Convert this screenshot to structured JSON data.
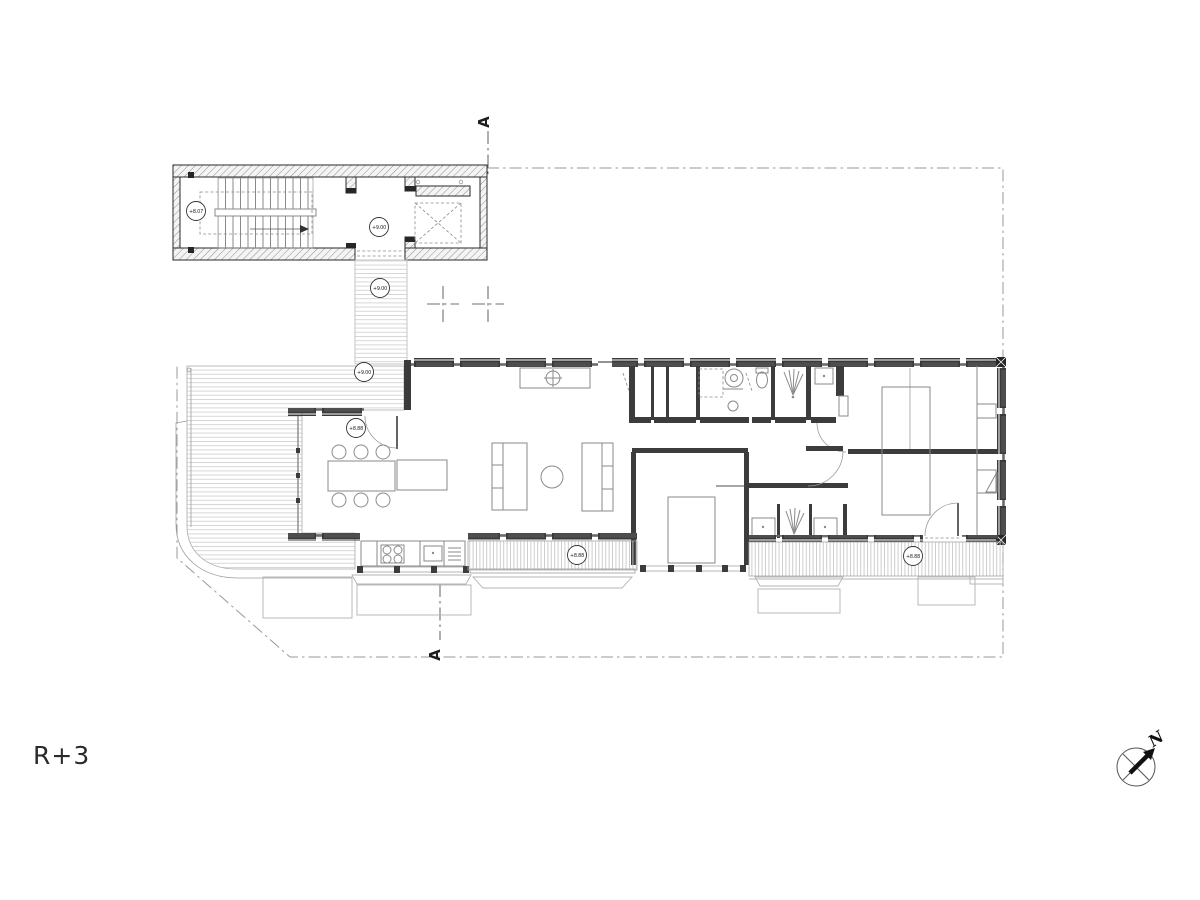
{
  "title": {
    "floor_label": "R+3"
  },
  "compass": {
    "north_label": "N"
  },
  "section": {
    "top_label": "A",
    "bottom_label": "A"
  },
  "levels": [
    {
      "id": "stair-flight",
      "value": "+8.07"
    },
    {
      "id": "stair-landing",
      "value": "+9.00"
    },
    {
      "id": "walkway",
      "value": "+9.00"
    },
    {
      "id": "terrace-deck",
      "value": "+9.00"
    },
    {
      "id": "living-room",
      "value": "+8.88"
    },
    {
      "id": "south-balcony",
      "value": "+8.88"
    },
    {
      "id": "east-balcony",
      "value": "+8.88"
    }
  ],
  "colors": {
    "paper": "#ffffff",
    "wall_hatch_line": "#8f8f8f",
    "wall_outline": "#2a2a2a",
    "glazing_dark": "#3a3a3a",
    "partition": "#3c3c3c",
    "furniture_line": "#8a8a8a",
    "deck_hatch": "#d2d2d2",
    "balcony_hatch": "#c9c9c9",
    "boundary_line": "#9a9a9a",
    "annotation": "#1d1d1d"
  }
}
